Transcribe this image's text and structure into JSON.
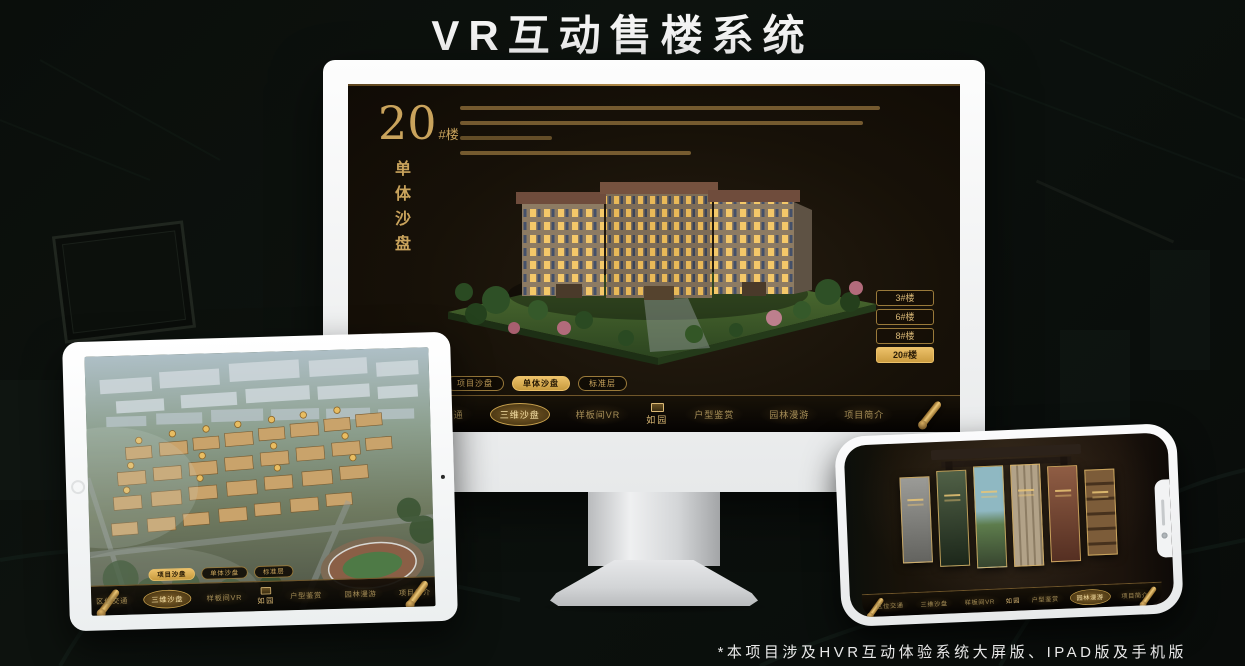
{
  "page": {
    "title": "VR互动售楼系统",
    "footnote": "*本项目涉及HVR互动体验系统大屏版、IPAD版及手机版"
  },
  "colors": {
    "gold_accent": "#c9a35c",
    "gold_active": "#e7bd63",
    "screen_background": "#171108",
    "device_frame": "#f2f3f4"
  },
  "monitor": {
    "panel": {
      "number": "20",
      "suffix": "#楼",
      "subtitle": "单体沙盘"
    },
    "floor_buttons": [
      {
        "label": "3#楼",
        "active": false
      },
      {
        "label": "6#楼",
        "active": false
      },
      {
        "label": "8#楼",
        "active": false
      },
      {
        "label": "20#楼",
        "active": true
      }
    ],
    "sub_tabs": [
      {
        "label": "项目沙盘",
        "active": false
      },
      {
        "label": "单体沙盘",
        "active": true
      },
      {
        "label": "标准层",
        "active": false
      }
    ],
    "nav": {
      "logo": "如园",
      "items": [
        {
          "label": "区位交通",
          "active": false
        },
        {
          "label": "三维沙盘",
          "active": true
        },
        {
          "label": "样板间VR",
          "active": false
        },
        {
          "label": "户型鉴赏",
          "active": false
        },
        {
          "label": "园林漫游",
          "active": false
        },
        {
          "label": "项目简介",
          "active": false
        }
      ]
    }
  },
  "tablet": {
    "sub_tabs": [
      {
        "label": "项目沙盘",
        "active": true
      },
      {
        "label": "单体沙盘",
        "active": false
      },
      {
        "label": "标准层",
        "active": false
      }
    ],
    "nav": {
      "logo": "如园",
      "items": [
        {
          "label": "区位交通",
          "active": false
        },
        {
          "label": "三维沙盘",
          "active": true
        },
        {
          "label": "样板间VR",
          "active": false
        },
        {
          "label": "户型鉴赏",
          "active": false
        },
        {
          "label": "园林漫游",
          "active": false
        },
        {
          "label": "项目简介",
          "active": false
        }
      ]
    }
  },
  "phone": {
    "nav": {
      "logo": "如园",
      "items": [
        {
          "label": "区位交通",
          "active": false
        },
        {
          "label": "三维沙盘",
          "active": false
        },
        {
          "label": "样板间VR",
          "active": false
        },
        {
          "label": "户型鉴赏",
          "active": false
        },
        {
          "label": "园林漫游",
          "active": true
        },
        {
          "label": "项目简介",
          "active": false
        }
      ]
    }
  }
}
